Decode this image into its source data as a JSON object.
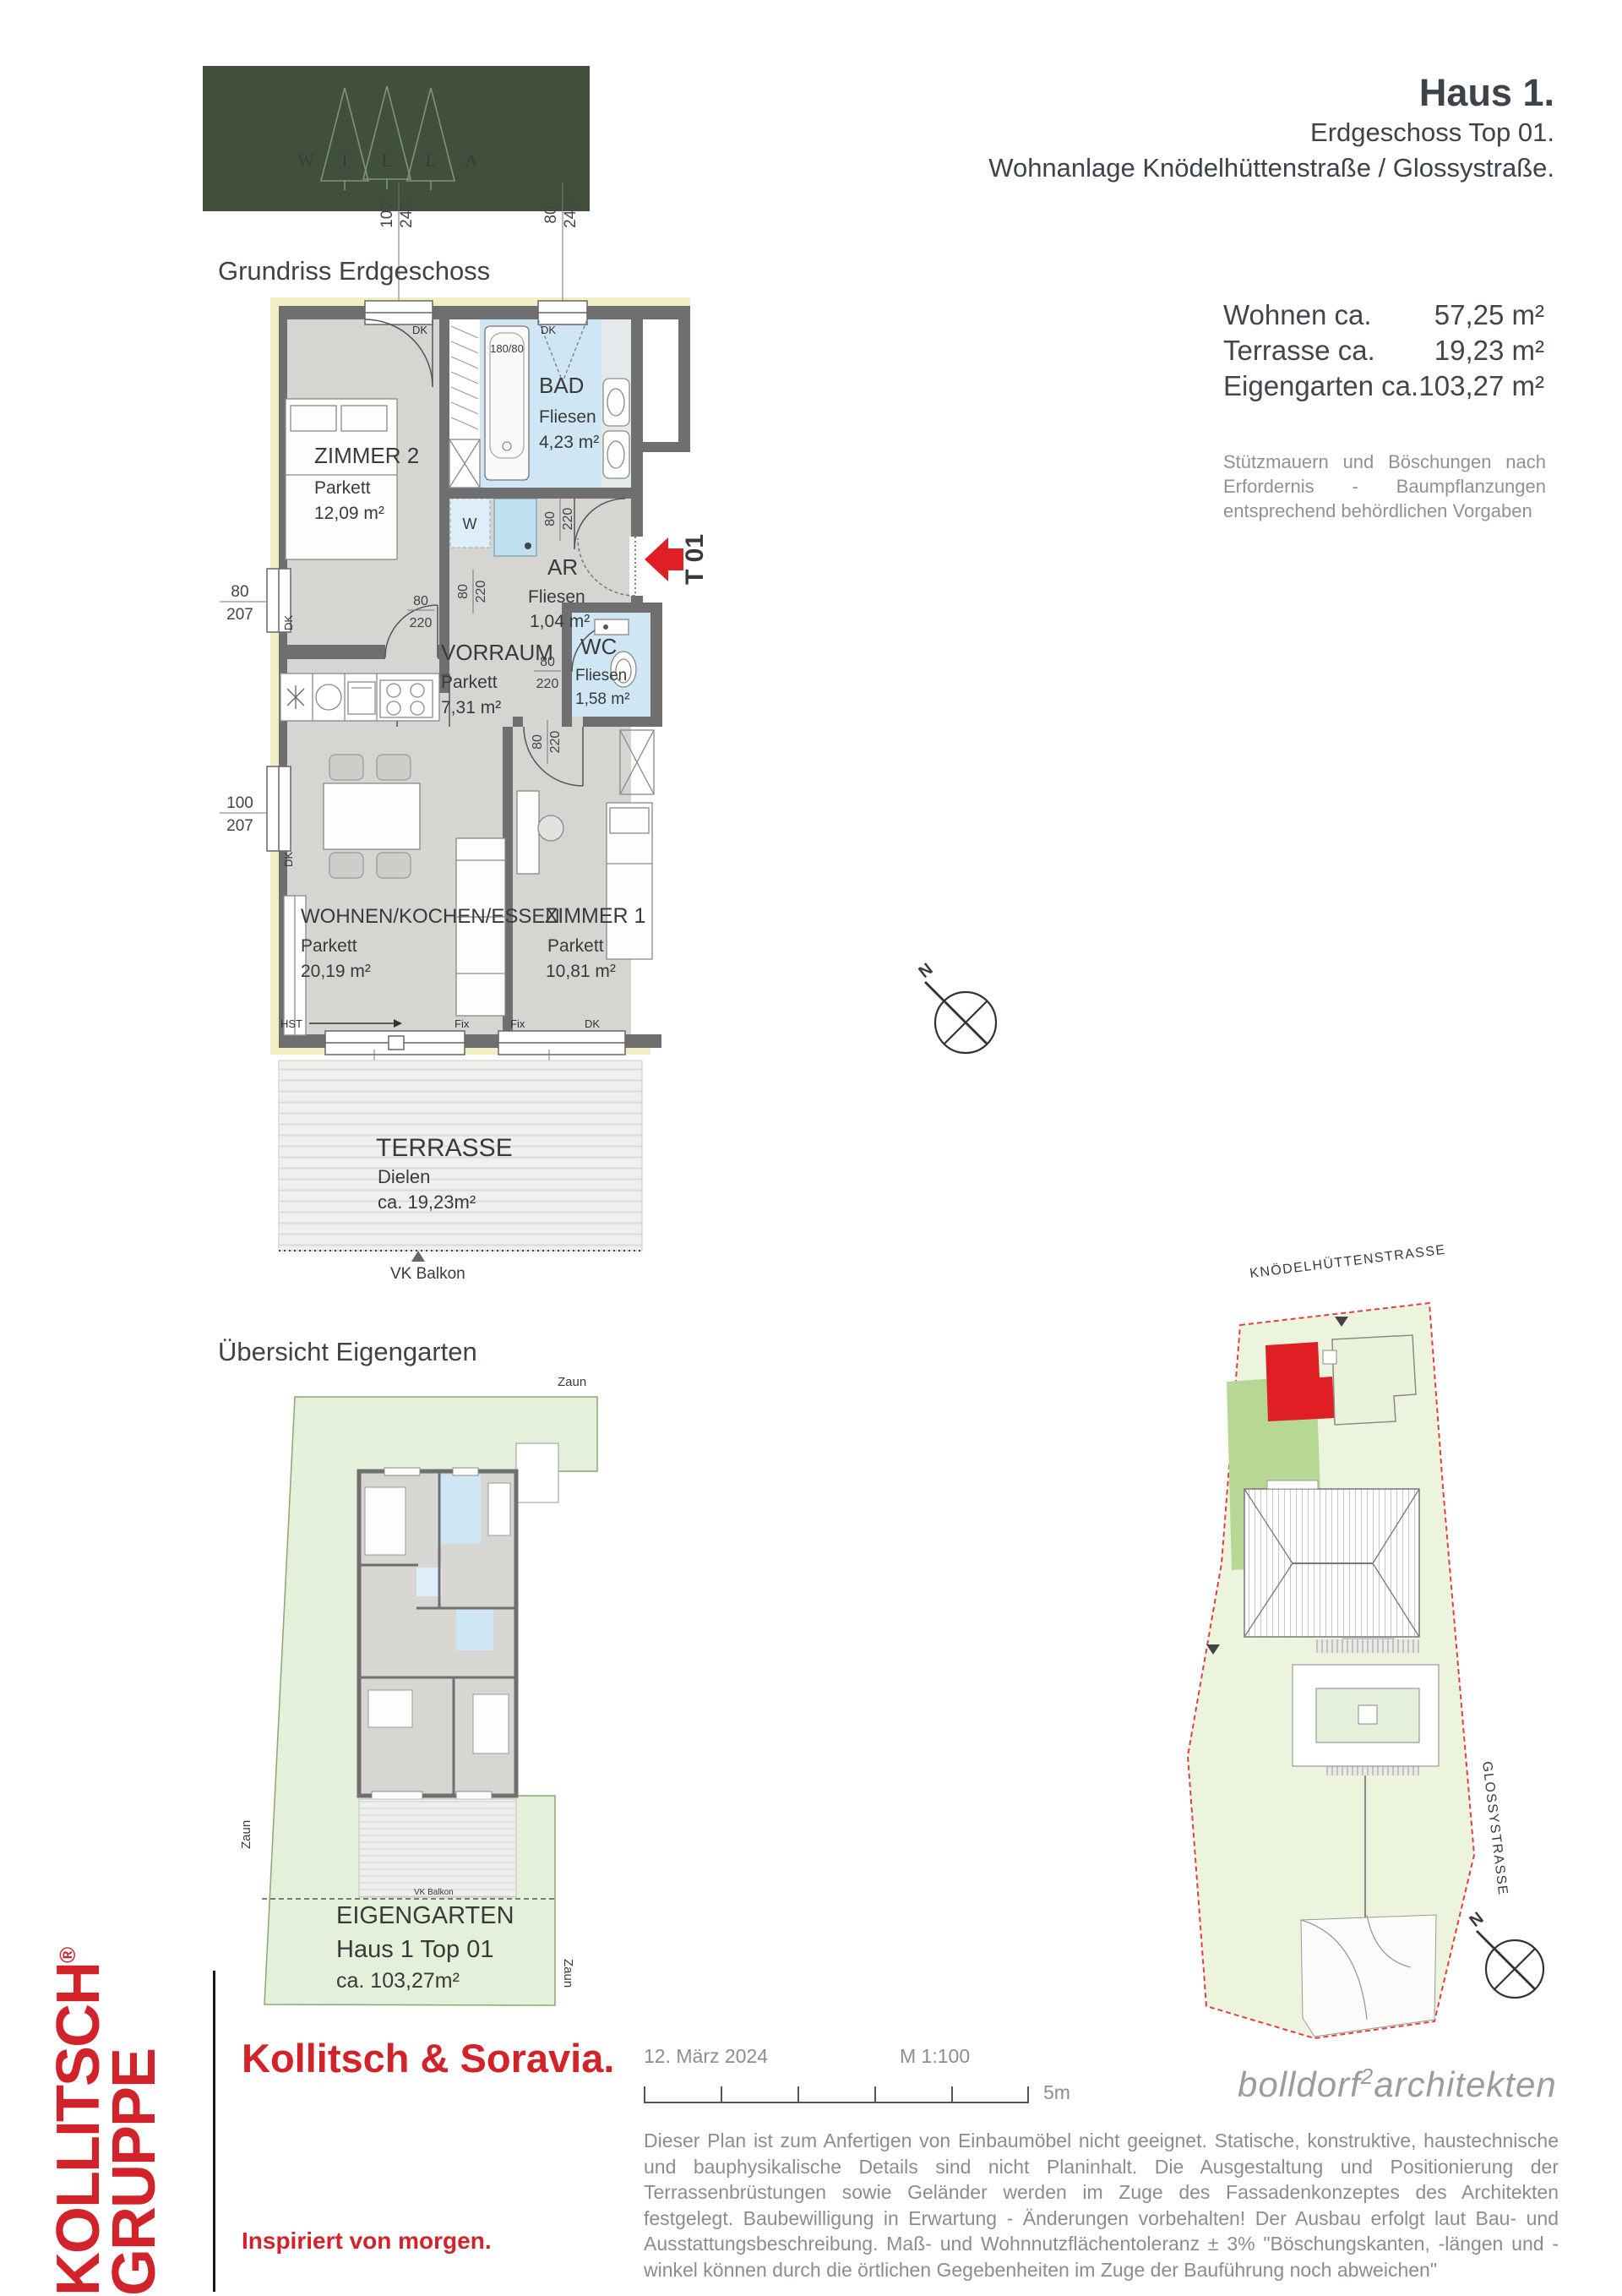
{
  "header": {
    "logo_letters": [
      "W",
      "I",
      "L",
      "L",
      "A"
    ],
    "title": "Haus 1.",
    "subtitle1": "Erdgeschoss Top 01.",
    "subtitle2": "Wohnanlage Knödelhüttenstraße / Glossystraße."
  },
  "plan": {
    "section_title": "Grundriss Erdgeschoss",
    "rooms": {
      "zimmer2": {
        "name": "ZIMMER 2",
        "floor": "Parkett",
        "area": "12,09 m²"
      },
      "bad": {
        "name": "BAD",
        "floor": "Fliesen",
        "area": "4,23 m²"
      },
      "ar": {
        "name": "AR",
        "floor": "Fliesen",
        "area": "1,04 m²"
      },
      "vorraum": {
        "name": "VORRAUM",
        "floor": "Parkett",
        "area": "7,31 m²"
      },
      "wc": {
        "name": "WC",
        "floor": "Fliesen",
        "area": "1,58 m²"
      },
      "wohnen": {
        "name": "WOHNEN/KOCHEN/ESSEN",
        "floor": "Parkett",
        "area": "20,19 m²"
      },
      "zimmer1": {
        "name": "ZIMMER 1",
        "floor": "Parkett",
        "area": "10,81 m²"
      },
      "terrasse": {
        "name": "TERRASSE",
        "floor": "Dielen",
        "area": "ca. 19,23m²"
      }
    },
    "dims": {
      "top1": {
        "n": "100",
        "d": "243"
      },
      "top2": {
        "n": "80",
        "d": "243"
      },
      "left1": {
        "n": "80",
        "d": "207"
      },
      "left2": {
        "n": "100",
        "d": "207"
      },
      "terr1": {
        "n": "350",
        "d": "243"
      },
      "terr2": {
        "n": "160",
        "d": "243"
      },
      "door": {
        "n": "80",
        "d": "220"
      },
      "tub": "180/80"
    },
    "marks": {
      "dk": "DK",
      "fix": "Fix",
      "hst": "HST",
      "w": "W",
      "t01": "T 01",
      "vk": "VK Balkon",
      "north": "N"
    }
  },
  "areas": {
    "rows": [
      {
        "label": "Wohnen ca.",
        "value": "57,25 m²"
      },
      {
        "label": "Terrasse ca.",
        "value": "19,23 m²"
      },
      {
        "label": "Eigengarten ca.",
        "value": "103,27 m²"
      }
    ],
    "note": "Stützmauern und Böschungen nach Erfordernis - Baumpflanzungen entsprechend behördlichen Vorgaben"
  },
  "garden": {
    "section_title": "Übersicht Eigengarten",
    "fence": "Zaun",
    "label": "EIGENGARTEN",
    "unit": "Haus 1 Top 01",
    "area": "ca. 103,27m²",
    "vk": "VK Balkon"
  },
  "siteplan": {
    "street_top": "KNÖDELHÜTTENSTRASSE",
    "street_right": "GLOSSYSTRASSE",
    "north": "N"
  },
  "footer": {
    "logo_line1": "KOLLITSCH",
    "logo_reg": "®",
    "logo_line2": "GRUPPE",
    "brand": "Kollitsch & Soravia.",
    "slogan": "Inspiriert von morgen.",
    "date": "12. März 2024",
    "scale": "M 1:100",
    "scale_len": "5m",
    "architect_pre": "bolldorf",
    "architect_sup": "2",
    "architect_post": "architekten",
    "disclaimer": "Dieser Plan ist zum Anfertigen von Einbaumöbel nicht geeignet. Statische, konstruktive, haustechnische und bauphysikalische Details sind nicht Planinhalt. Die Ausgestaltung und Positionierung der Terrassenbrüstungen sowie Geländer werden im Zuge des Fassadenkonzeptes des Architekten festgelegt. Baubewilligung in Erwartung - Änderungen vorbehalten! Der Ausbau erfolgt laut Bau- und Ausstattungsbeschreibung. Maß- und Wohnnutzflächentoleranz ± 3% \"Böschungskanten, -längen und -winkel können durch die örtlichen Gegebenheiten im Zuge der Bauführung noch abweichen\""
  },
  "colors": {
    "brand_red": "#d2232a",
    "logo_green": "#41503d",
    "wall_gray": "#6f6f6f",
    "room_gray": "#d7d5d2",
    "wet_blue": "#cfe7f4",
    "insulation_yellow": "#f1eec3",
    "garden_green": "#e4f0d9",
    "site_unit_red": "#e01f24"
  }
}
